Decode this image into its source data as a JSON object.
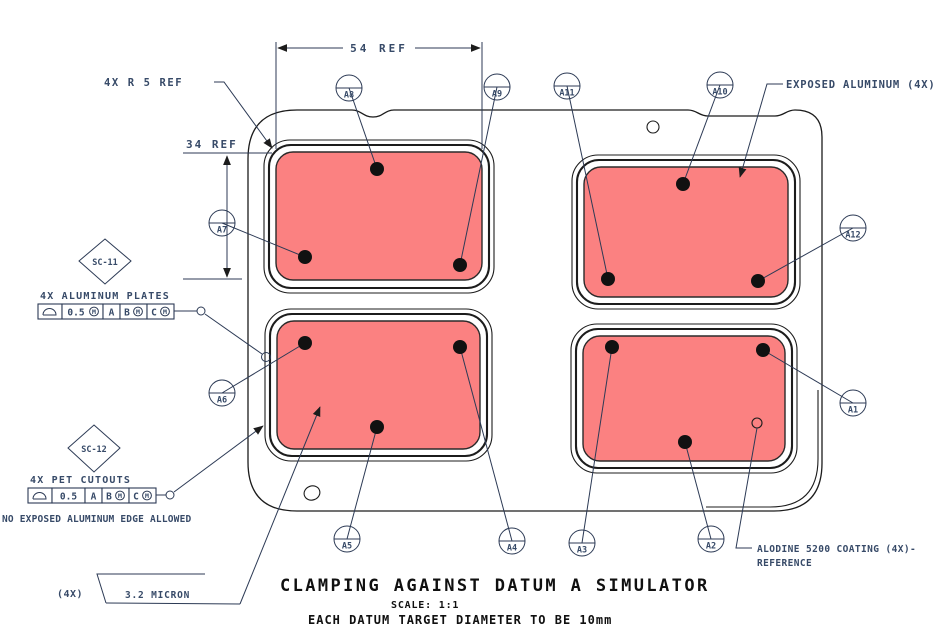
{
  "drawing": {
    "title": "CLAMPING AGAINST DATUM A SIMULATOR",
    "scale": "SCALE:  1:1",
    "note": "EACH DATUM TARGET DIAMETER TO BE 10mm"
  },
  "dims": {
    "width_ref": "54 REF",
    "height_ref": "34 REF",
    "corner_radius": "4X R 5 REF"
  },
  "notes": {
    "exposed": "EXPOSED ALUMINUM (4X)",
    "alodine1": "ALODINE 5200 COATING (4X)-",
    "alodine2": "REFERENCE",
    "no_edge": "NO EXPOSED ALUMINUM EDGE ALLOWED",
    "qty4x": "(4X)",
    "micron": "3.2 MICRON"
  },
  "diamonds": {
    "sc11": "SC-11",
    "sc12": "SC-12"
  },
  "fcfs": [
    {
      "label": "4X ALUMINUM PLATES",
      "x": 38,
      "y": 304,
      "cells": [
        {
          "sym": true,
          "w": 24
        },
        {
          "t": "0.5",
          "mod": true,
          "w": 41
        },
        {
          "t": "A",
          "w": 17
        },
        {
          "t": "B",
          "mod": true,
          "w": 27
        },
        {
          "t": "C",
          "mod": true,
          "w": 27
        }
      ]
    },
    {
      "label": "4X PET CUTOUTS",
      "x": 28,
      "y": 488,
      "cells": [
        {
          "sym": true,
          "w": 24
        },
        {
          "t": "0.5",
          "w": 33
        },
        {
          "t": "A",
          "w": 17
        },
        {
          "t": "B",
          "mod": true,
          "w": 27
        },
        {
          "t": "C",
          "mod": true,
          "w": 27
        }
      ]
    }
  ],
  "targets": [
    {
      "id": "A1",
      "bx": 853,
      "by": 403,
      "dx": 763,
      "dy": 350
    },
    {
      "id": "A2",
      "bx": 711,
      "by": 539,
      "dx": 685,
      "dy": 442
    },
    {
      "id": "A3",
      "bx": 582,
      "by": 543,
      "dx": 612,
      "dy": 347
    },
    {
      "id": "A4",
      "bx": 512,
      "by": 541,
      "dx": 460,
      "dy": 347
    },
    {
      "id": "A5",
      "bx": 347,
      "by": 539,
      "dx": 377,
      "dy": 427
    },
    {
      "id": "A6",
      "bx": 222,
      "by": 393,
      "dx": 305,
      "dy": 343
    },
    {
      "id": "A7",
      "bx": 222,
      "by": 223,
      "dx": 305,
      "dy": 257
    },
    {
      "id": "A8",
      "bx": 349,
      "by": 88,
      "dx": 377,
      "dy": 169
    },
    {
      "id": "A9",
      "bx": 497,
      "by": 87,
      "dx": 460,
      "dy": 265
    },
    {
      "id": "A10",
      "bx": 720,
      "by": 85,
      "dx": 683,
      "dy": 184
    },
    {
      "id": "A11",
      "bx": 567,
      "by": 86,
      "dx": 608,
      "dy": 279
    },
    {
      "id": "A12",
      "bx": 853,
      "by": 228,
      "dx": 758,
      "dy": 281
    }
  ],
  "colors": {
    "plate_fill": "#fb8181",
    "line": "#1c1c1c",
    "annotation_text": "#374a68",
    "title_text": "#101010",
    "background": "#ffffff"
  }
}
